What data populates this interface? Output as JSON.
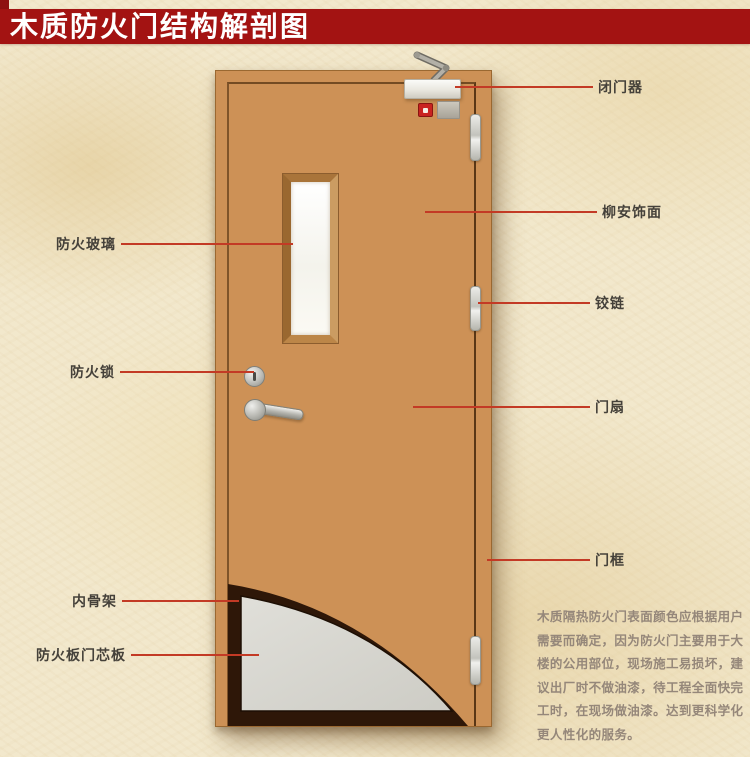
{
  "banner": {
    "title": "木质防火门结构解剖图",
    "bg_color": "#a31312",
    "text_color": "#ffffff"
  },
  "diagram": {
    "line_color": "#c33a25",
    "callouts_left": [
      {
        "label": "防火玻璃"
      },
      {
        "label": "防火锁"
      },
      {
        "label": "内骨架"
      },
      {
        "label": "防火板门芯板"
      }
    ],
    "callouts_right": [
      {
        "label": "闭门器"
      },
      {
        "label": "柳安饰面"
      },
      {
        "label": "铰链"
      },
      {
        "label": "门扇"
      },
      {
        "label": "门框"
      }
    ]
  },
  "door": {
    "wood_color": "#cd9156",
    "glass_color": "#fbfaf4",
    "skeleton_color": "#2e1708",
    "core_board_color": "#d7d6d0",
    "hardware_color": "#c6c6c0"
  },
  "description": {
    "text_color": "#95877a",
    "lines": [
      "木质隔热防火门表面颜色应根据用户",
      "需要而确定，因为防火门主要用于大",
      "楼的公用部位，现场施工易损坏，建",
      "议出厂时不做油漆，待工程全面快完",
      "工时，在现场做油漆。达到更科学化",
      "更人性化的服务。"
    ]
  }
}
